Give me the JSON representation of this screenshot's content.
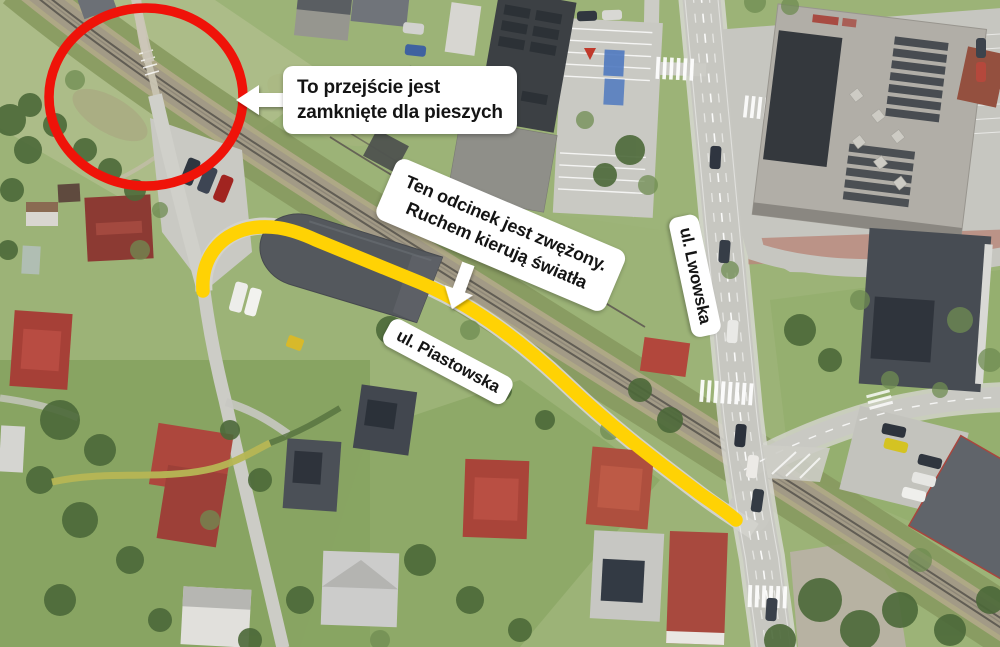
{
  "colors": {
    "highlight_route": "#FFD204",
    "alert_circle": "#EF1309",
    "arrow_fill": "#FFFFFF",
    "label_background": "#FFFFFF",
    "label_text": "#141414"
  },
  "annotations": {
    "closed_crossing_note": {
      "line1": "To przejście jest",
      "line2": "zamknięte dla pieszych"
    },
    "narrowed_section_note": {
      "line1": "Ten odcinek jest zwężony.",
      "line2": "Ruchem kierują światła"
    }
  },
  "street_labels": {
    "piastowska": "ul. Piastowska",
    "lwowska": "ul. Lwowska"
  }
}
